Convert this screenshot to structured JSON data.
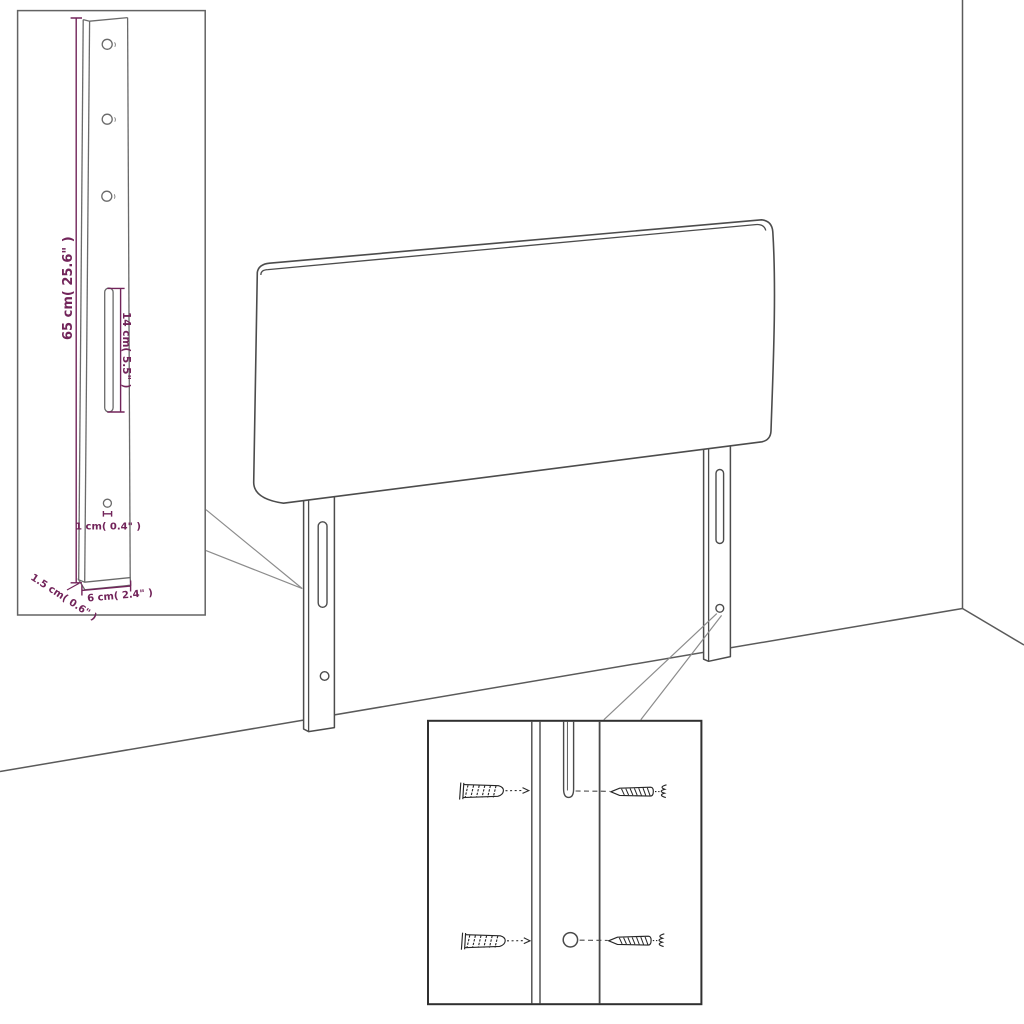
{
  "scene": {
    "description": "Line-art product diagram of an upholstered headboard with two wall-mount legs, shown in a room corner, with two magnified detail insets",
    "background_color": "#ffffff",
    "colors": {
      "drawing_line": "#4c4c4c",
      "dimension_accent": "#72245a",
      "inset_border": "#636363",
      "hardware_inset_border": "#303030"
    },
    "parts": [
      "headboard panel",
      "left mounting leg",
      "right mounting leg",
      "wall corner",
      "floor"
    ]
  },
  "leg_detail_inset": {
    "dim_height": "65 cm( 25.6\" )",
    "dim_slot": "14 cm( 5.5\" )",
    "dim_hole": "1 cm( 0.4\" )",
    "dim_thickness": "1.5 cm( 0.6\" )",
    "dim_width": "6 cm( 2.4\" )",
    "hole_count": 3
  },
  "hardware_detail_inset": {
    "icons": {
      "wall_plug_icon": "ribbed-wall-anchor-shape",
      "screw_icon": "pointed-thread-screw-shape",
      "leader_arrow_icon": "right-chevron-arrow"
    },
    "rows": 2
  }
}
